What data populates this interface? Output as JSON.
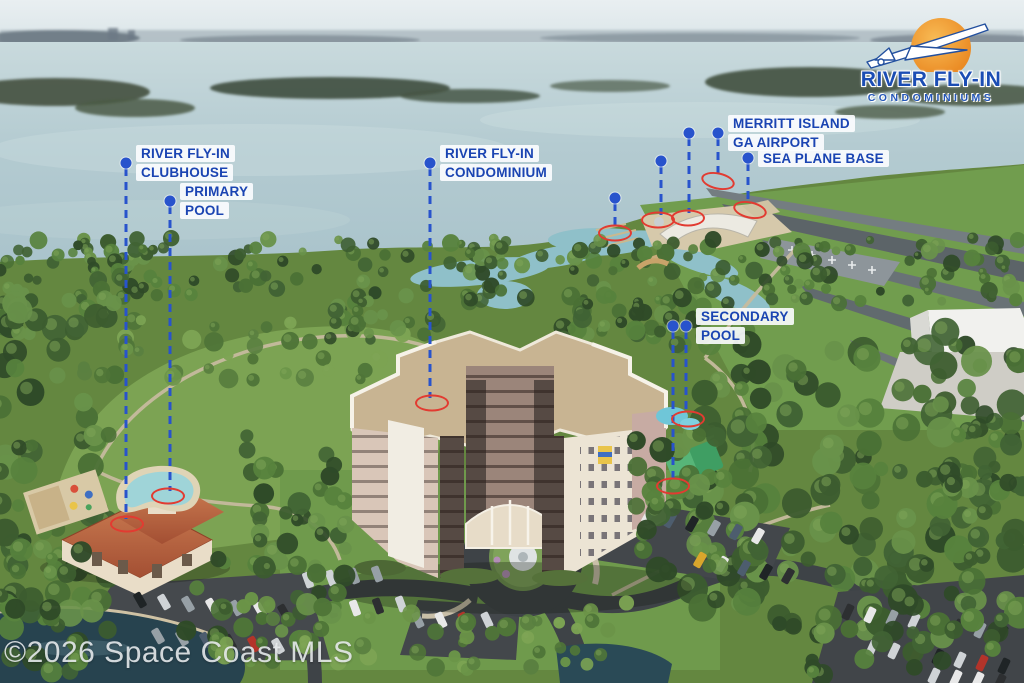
{
  "branding": {
    "logo_line1": "RIVER FLY-IN",
    "logo_line2": "CONDOMINIUMS",
    "logo_sun_color": "#f09a2e",
    "logo_text_color": "#1b4db4"
  },
  "watermark": "©2026 Space Coast MLS",
  "colors": {
    "callout_text": "#1a44b2",
    "leader_line": "#2853cc",
    "target_ring": "#e23b31"
  },
  "callouts": [
    {
      "id": "river-fly-in-clubhouse",
      "lines": [
        "RIVER FLY-IN",
        "CLUBHOUSE"
      ]
    },
    {
      "id": "primary-pool",
      "lines": [
        "PRIMARY",
        "POOL"
      ]
    },
    {
      "id": "river-fly-in-condominium",
      "lines": [
        "RIVER FLY-IN",
        "CONDOMINIUM"
      ]
    },
    {
      "id": "fbo-restaurant",
      "lines": [
        "FBO/RESTAURANT"
      ]
    },
    {
      "id": "merritt-island-ga-airport",
      "lines": [
        "MERRITT ISLAND",
        "GA AIRPORT"
      ]
    },
    {
      "id": "e-vtol-helipad",
      "lines": [
        "E-VTOL",
        "HELIPAD"
      ]
    },
    {
      "id": "sea-plane-base",
      "lines": [
        "SEA PLANE BASE"
      ]
    },
    {
      "id": "marina",
      "lines": [
        "MARINA"
      ]
    },
    {
      "id": "versacourt",
      "lines": [
        "VERSACOURT"
      ]
    },
    {
      "id": "secondary-pool",
      "lines": [
        "SECONDARY",
        "POOL"
      ]
    }
  ]
}
